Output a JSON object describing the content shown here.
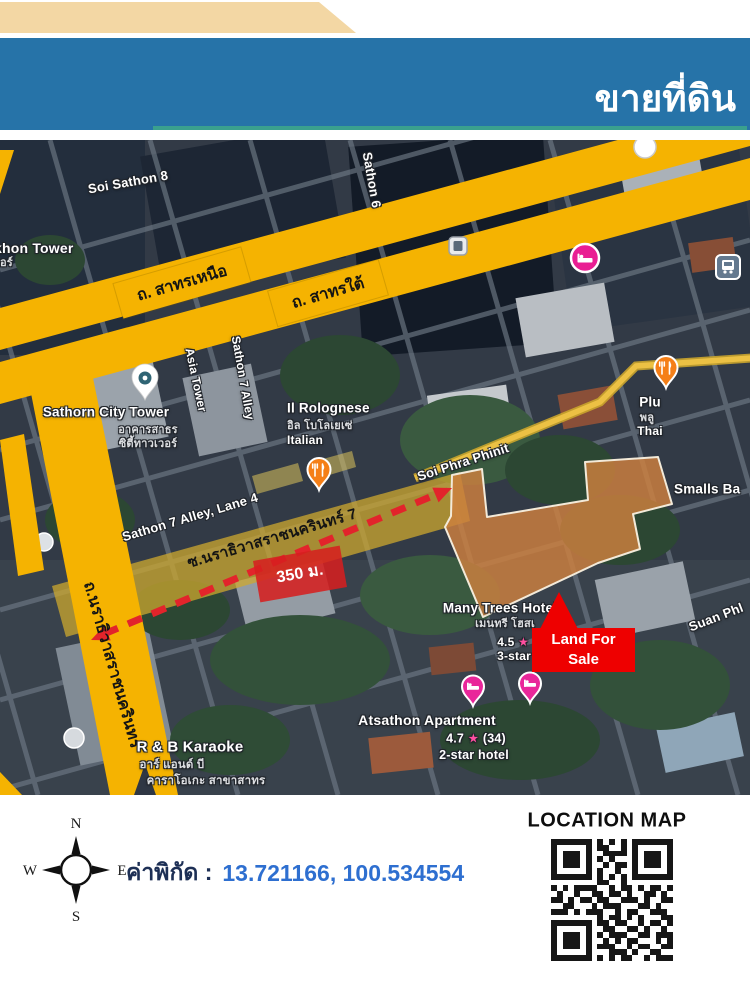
{
  "header": {
    "title": "ขายที่ดิน",
    "subtitle": "ซอยนราธิวาสราชนครินทร์ 7  เขตสาทาร กรุงเทพมหานคร"
  },
  "map": {
    "roads": {
      "soi_sathon8": "Soi Sathon 8",
      "sathon6": "Sathon 6",
      "sathon_north": "ถ. สาทรเหนือ",
      "sathon_south": "ถ. สาทรใต้",
      "sathon7_alley": "Sathon 7 Alley",
      "sathon7_lane4": "Sathon 7 Alley, Lane 4",
      "soi_narathiwat7": "ซ.นราธิวาสราชนครินทร์ 7",
      "narathiwat": "ถ.นราธิวาสราชนครินทร์",
      "soi_phra_phinit": "Soi Phra Phinit",
      "suan_phlu": "Suan Phl"
    },
    "places": {
      "sakhon_tower": "khon Tower",
      "sakhon_tower_thai": "อร์",
      "sathorn_city_tower": "Sathorn City Tower",
      "sathorn_city_thai1": "อาคารสาธร",
      "sathorn_city_thai2": "ซิตี้ทาวเวอร์",
      "asia_tower": "Asia Tower",
      "il_rolognese": "Il Rolognese",
      "il_rolognese_thai": "อิล โบโลเยเซ่",
      "il_rolognese_type": "Italian",
      "plu": "Plu",
      "plu_thai": "พลู",
      "plu_type": "Thai",
      "smalls_bar": "Smalls Ba",
      "many_trees": "Many Trees Hotel",
      "many_trees_thai": "เมนทรี โฮสเ",
      "many_trees_rating": "4.5",
      "many_trees_star": "★",
      "many_trees_class": "3-star",
      "atsathon": "Atsathon Apartment",
      "atsathon_rating": "4.7",
      "atsathon_star": "★",
      "atsathon_reviews": "(34)",
      "atsathon_class": "2-star hotel",
      "karaoke": "R & B Karaoke",
      "karaoke_thai1": "อาร์ แอนด์ บี",
      "karaoke_thai2": "คาราโอเกะ สาขาสาทร"
    },
    "annotations": {
      "distance": "350 ม.",
      "land_for_sale_line1": "Land For",
      "land_for_sale_line2": "Sale"
    }
  },
  "footer": {
    "compass": {
      "n": "N",
      "s": "S",
      "e": "E",
      "w": "W"
    },
    "coords_label": "ค่าพิกัด :",
    "coords_value": "13.721166, 100.534554",
    "location_map_label": "LOCATION MAP"
  },
  "colors": {
    "banner_blue": "#2673a8",
    "tan": "#f3d7a4",
    "teal_line": "#3aa08e",
    "road_yellow": "#f5b301",
    "parcel_orange": "#cd7f3e",
    "alert_red": "#ee0000",
    "coord_blue": "#2e6fd0",
    "hotel_pin_pink": "#e91e93",
    "restaurant_pin_orange": "#f57f17"
  },
  "qr": {
    "matrix": [
      "111111101010101111111",
      "100000101100101000001",
      "101110100111101011101",
      "101110101010001011101",
      "101110100101101011101",
      "100000101001001000001",
      "111111101010101111111",
      "000000001100100000000",
      "101011110010110101101",
      "010010011011010011010",
      "110101101100111010011",
      "001100010111000110100",
      "111010111001011001110",
      "000000001011010100011",
      "111111101101100101101",
      "100000100110011010010",
      "101110101011100110111",
      "101110100101011000101",
      "101110101110010110011",
      "100000100011101001100",
      "111111101010110010111"
    ]
  }
}
